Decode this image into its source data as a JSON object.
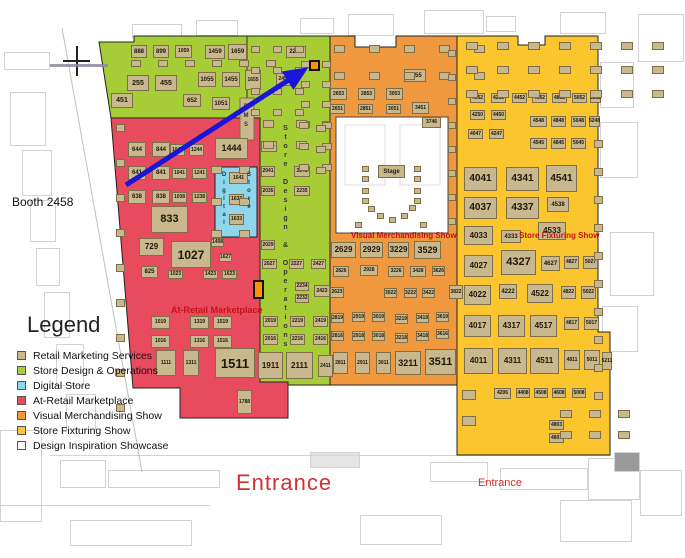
{
  "callout": {
    "label": "Booth 2458"
  },
  "legend": {
    "title": "Legend",
    "items": [
      {
        "label": "Retail Marketing Services",
        "color_key": "tan"
      },
      {
        "label": "Store Design & Operations",
        "color_key": "green"
      },
      {
        "label": "Digital Store",
        "color_key": "blue"
      },
      {
        "label": "At-Retail Marketplace",
        "color_key": "red"
      },
      {
        "label": "Visual Merchandising Show",
        "color_key": "orange"
      },
      {
        "label": "Store Fixturing Show",
        "color_key": "yellow"
      },
      {
        "label": "Design Inspiration Showcase",
        "color_key": "white"
      }
    ]
  },
  "map_labels": {
    "at_retail": "At-Retail Marketplace",
    "visual_merch": "Visual Merchandising Show",
    "store_fixturing": "Store Fixturing Show",
    "stage": "Stage",
    "rms": "RMS",
    "store_design_ops": "Store Design & Operations",
    "digital": "Digital",
    "store": "Store",
    "entrance_main": "Entrance",
    "entrance_side": "Entrance"
  },
  "colors": {
    "tan": "#c9b88e",
    "green": "#a6cc36",
    "blue": "#8ed6ec",
    "red": "#e84a5e",
    "orange": "#f0983e",
    "yellow": "#fbc52e",
    "white": "#ffffff",
    "highlight": "#ff9000",
    "arrow": "#1a16d8",
    "label_red": "#c41414",
    "entrance": "#d23030"
  },
  "booths": [
    [
      "888",
      131,
      45,
      16,
      13,
      6
    ],
    [
      "899",
      153,
      45,
      16,
      13,
      6
    ],
    [
      "1059",
      175,
      45,
      17,
      13,
      5
    ],
    [
      "1459",
      205,
      45,
      20,
      14,
      6
    ],
    [
      "1659",
      228,
      44,
      19,
      16,
      6
    ],
    [
      "2299",
      286,
      46,
      20,
      12,
      6
    ],
    [
      "255",
      127,
      75,
      22,
      16,
      7
    ],
    [
      "455",
      155,
      75,
      22,
      16,
      7
    ],
    [
      "1055",
      198,
      72,
      18,
      15,
      6
    ],
    [
      "1455",
      222,
      72,
      18,
      15,
      6
    ],
    [
      "1655",
      245,
      70,
      16,
      20,
      5
    ],
    [
      "2455",
      276,
      73,
      16,
      13,
      5
    ],
    [
      "451",
      111,
      93,
      22,
      15,
      7
    ],
    [
      "652",
      183,
      94,
      18,
      13,
      6
    ],
    [
      "1051",
      212,
      97,
      18,
      13,
      6
    ],
    [
      "2044",
      261,
      141,
      16,
      11,
      5
    ],
    [
      "2041",
      261,
      166,
      14,
      11,
      5
    ],
    [
      "2241",
      294,
      166,
      16,
      11,
      5
    ],
    [
      "2035",
      261,
      186,
      14,
      10,
      5
    ],
    [
      "2235",
      294,
      186,
      16,
      10,
      5
    ],
    [
      "2029",
      261,
      240,
      14,
      10,
      5
    ],
    [
      "2027",
      262,
      259,
      15,
      10,
      5
    ],
    [
      "2227",
      289,
      259,
      15,
      10,
      5
    ],
    [
      "2427",
      311,
      259,
      15,
      10,
      5
    ],
    [
      "2234",
      295,
      282,
      14,
      9,
      5
    ],
    [
      "2232",
      295,
      294,
      14,
      9,
      5
    ],
    [
      "2423",
      314,
      285,
      16,
      12,
      5
    ],
    [
      "2019",
      263,
      316,
      15,
      11,
      5
    ],
    [
      "2219",
      290,
      316,
      15,
      11,
      5
    ],
    [
      "2419",
      313,
      316,
      15,
      11,
      5
    ],
    [
      "2016",
      263,
      334,
      15,
      11,
      5
    ],
    [
      "2216",
      290,
      334,
      15,
      11,
      5
    ],
    [
      "2416",
      313,
      334,
      15,
      11,
      5
    ],
    [
      "1911",
      258,
      352,
      25,
      27,
      8
    ],
    [
      "2111",
      286,
      352,
      27,
      27,
      8
    ],
    [
      "2411",
      318,
      355,
      15,
      22,
      5
    ],
    [
      "644",
      128,
      142,
      18,
      15,
      6
    ],
    [
      "844",
      152,
      142,
      18,
      15,
      6
    ],
    [
      "1044",
      170,
      144,
      15,
      12,
      5
    ],
    [
      "1244",
      189,
      144,
      15,
      12,
      5
    ],
    [
      "1444",
      215,
      138,
      33,
      21,
      9
    ],
    [
      "641",
      128,
      166,
      18,
      14,
      6
    ],
    [
      "841",
      152,
      166,
      18,
      14,
      6
    ],
    [
      "1041",
      172,
      168,
      15,
      11,
      5
    ],
    [
      "1241",
      192,
      168,
      15,
      11,
      5
    ],
    [
      "638",
      128,
      190,
      18,
      14,
      6
    ],
    [
      "838",
      152,
      190,
      18,
      14,
      6
    ],
    [
      "1038",
      172,
      192,
      15,
      11,
      5
    ],
    [
      "1238",
      192,
      192,
      15,
      11,
      5
    ],
    [
      "833",
      151,
      206,
      37,
      27,
      11
    ],
    [
      "729",
      139,
      238,
      25,
      18,
      8
    ],
    [
      "1027",
      171,
      241,
      40,
      27,
      12
    ],
    [
      "825",
      141,
      266,
      17,
      12,
      6
    ],
    [
      "1408",
      211,
      238,
      13,
      9,
      5
    ],
    [
      "1627",
      219,
      253,
      13,
      9,
      5
    ],
    [
      "1023",
      168,
      270,
      15,
      9,
      5
    ],
    [
      "1423",
      203,
      270,
      15,
      9,
      5
    ],
    [
      "1623",
      222,
      270,
      15,
      9,
      5
    ],
    [
      "1019",
      151,
      316,
      19,
      13,
      5
    ],
    [
      "1319",
      190,
      316,
      19,
      13,
      5
    ],
    [
      "1519",
      213,
      316,
      19,
      13,
      5
    ],
    [
      "1016",
      151,
      335,
      19,
      13,
      5
    ],
    [
      "1316",
      190,
      335,
      19,
      13,
      5
    ],
    [
      "1516",
      213,
      335,
      19,
      13,
      5
    ],
    [
      "1111",
      156,
      350,
      20,
      26,
      5
    ],
    [
      "1311",
      183,
      350,
      16,
      26,
      5
    ],
    [
      "1511",
      215,
      348,
      40,
      30,
      13
    ],
    [
      "1788",
      237,
      390,
      15,
      24,
      5
    ],
    [
      "1641",
      229,
      172,
      19,
      12,
      5
    ],
    [
      "1637",
      229,
      194,
      15,
      11,
      5
    ],
    [
      "1633",
      229,
      214,
      15,
      11,
      5
    ],
    [
      "3455",
      404,
      69,
      22,
      13,
      6
    ],
    [
      "2653",
      330,
      88,
      17,
      12,
      5
    ],
    [
      "2853",
      358,
      88,
      17,
      12,
      5
    ],
    [
      "3053",
      386,
      88,
      17,
      12,
      5
    ],
    [
      "2651",
      330,
      104,
      15,
      10,
      5
    ],
    [
      "2851",
      358,
      104,
      15,
      10,
      5
    ],
    [
      "3051",
      386,
      104,
      15,
      10,
      5
    ],
    [
      "3451",
      412,
      102,
      17,
      12,
      5
    ],
    [
      "3746",
      422,
      117,
      19,
      11,
      5
    ],
    [
      "2629",
      331,
      242,
      25,
      16,
      8
    ],
    [
      "2929",
      360,
      242,
      23,
      16,
      8
    ],
    [
      "3229",
      388,
      242,
      21,
      16,
      8
    ],
    [
      "3529",
      414,
      241,
      27,
      18,
      9
    ],
    [
      "2826",
      333,
      266,
      16,
      11,
      5
    ],
    [
      "2928",
      360,
      265,
      18,
      11,
      5
    ],
    [
      "3226",
      388,
      266,
      16,
      11,
      5
    ],
    [
      "3428",
      410,
      266,
      16,
      11,
      5
    ],
    [
      "3626",
      432,
      266,
      13,
      10,
      5
    ],
    [
      "2623",
      330,
      287,
      14,
      11,
      5
    ],
    [
      "3022",
      384,
      288,
      13,
      10,
      5
    ],
    [
      "3222",
      404,
      288,
      13,
      10,
      5
    ],
    [
      "3422",
      422,
      288,
      13,
      10,
      5
    ],
    [
      "3822",
      449,
      285,
      14,
      14,
      5
    ],
    [
      "2819",
      331,
      313,
      13,
      10,
      5
    ],
    [
      "2919",
      352,
      312,
      13,
      10,
      5
    ],
    [
      "3019",
      372,
      312,
      13,
      10,
      5
    ],
    [
      "3219",
      395,
      314,
      13,
      10,
      5
    ],
    [
      "3419",
      416,
      313,
      13,
      10,
      5
    ],
    [
      "3619",
      436,
      312,
      13,
      10,
      5
    ],
    [
      "2816",
      331,
      331,
      13,
      10,
      5
    ],
    [
      "2918",
      352,
      331,
      13,
      10,
      5
    ],
    [
      "3018",
      372,
      331,
      13,
      10,
      5
    ],
    [
      "3218",
      395,
      333,
      13,
      10,
      5
    ],
    [
      "3418",
      416,
      331,
      13,
      10,
      5
    ],
    [
      "3616",
      436,
      329,
      13,
      10,
      5
    ],
    [
      "2811",
      333,
      352,
      15,
      22,
      5
    ],
    [
      "2911",
      355,
      352,
      15,
      22,
      5
    ],
    [
      "3011",
      376,
      352,
      15,
      22,
      5
    ],
    [
      "3211",
      395,
      351,
      26,
      24,
      9
    ],
    [
      "3511",
      425,
      349,
      31,
      26,
      11
    ],
    [
      "4052",
      470,
      93,
      15,
      10,
      5
    ],
    [
      "4252",
      491,
      93,
      15,
      10,
      5
    ],
    [
      "4452",
      512,
      93,
      15,
      10,
      5
    ],
    [
      "4652",
      532,
      93,
      15,
      10,
      5
    ],
    [
      "4852",
      552,
      93,
      15,
      10,
      5
    ],
    [
      "5052",
      572,
      93,
      15,
      10,
      5
    ],
    [
      "5252",
      590,
      93,
      11,
      10,
      5
    ],
    [
      "4250",
      470,
      110,
      15,
      10,
      5
    ],
    [
      "4450",
      491,
      110,
      15,
      10,
      5
    ],
    [
      "4548",
      530,
      116,
      17,
      11,
      5
    ],
    [
      "4848",
      551,
      116,
      15,
      11,
      5
    ],
    [
      "5048",
      571,
      116,
      15,
      11,
      5
    ],
    [
      "5248",
      589,
      116,
      11,
      11,
      5
    ],
    [
      "4047",
      468,
      129,
      15,
      10,
      5
    ],
    [
      "4247",
      489,
      129,
      15,
      10,
      5
    ],
    [
      "4545",
      530,
      138,
      17,
      11,
      5
    ],
    [
      "4845",
      551,
      138,
      15,
      11,
      5
    ],
    [
      "5045",
      571,
      138,
      15,
      11,
      5
    ],
    [
      "4041",
      464,
      167,
      33,
      24,
      10
    ],
    [
      "4341",
      506,
      167,
      33,
      24,
      10
    ],
    [
      "4541",
      546,
      165,
      31,
      27,
      10
    ],
    [
      "4037",
      464,
      197,
      33,
      22,
      10
    ],
    [
      "4337",
      506,
      197,
      33,
      22,
      10
    ],
    [
      "4538",
      547,
      197,
      22,
      15,
      6
    ],
    [
      "4033",
      464,
      226,
      29,
      19,
      8
    ],
    [
      "4333",
      501,
      230,
      20,
      13,
      6
    ],
    [
      "4533",
      538,
      222,
      28,
      18,
      8
    ],
    [
      "4027",
      464,
      255,
      29,
      22,
      8
    ],
    [
      "4327",
      501,
      250,
      35,
      25,
      11
    ],
    [
      "4627",
      541,
      256,
      19,
      15,
      6
    ],
    [
      "4827",
      564,
      256,
      15,
      13,
      5
    ],
    [
      "5027",
      583,
      256,
      15,
      13,
      5
    ],
    [
      "4022",
      464,
      285,
      27,
      20,
      8
    ],
    [
      "4222",
      499,
      284,
      18,
      15,
      6
    ],
    [
      "4522",
      527,
      284,
      26,
      19,
      8
    ],
    [
      "4822",
      561,
      286,
      15,
      13,
      5
    ],
    [
      "5022",
      581,
      286,
      15,
      13,
      5
    ],
    [
      "4017",
      464,
      315,
      27,
      22,
      8
    ],
    [
      "4317",
      498,
      315,
      27,
      22,
      8
    ],
    [
      "4517",
      530,
      315,
      27,
      22,
      8
    ],
    [
      "4817",
      564,
      317,
      15,
      13,
      5
    ],
    [
      "5017",
      584,
      317,
      15,
      13,
      5
    ],
    [
      "4011",
      464,
      348,
      29,
      26,
      8
    ],
    [
      "4311",
      498,
      348,
      29,
      26,
      8
    ],
    [
      "4511",
      530,
      348,
      29,
      26,
      8
    ],
    [
      "4811",
      564,
      350,
      16,
      20,
      5
    ],
    [
      "5011",
      584,
      350,
      16,
      20,
      5
    ],
    [
      "5211",
      602,
      352,
      10,
      18,
      5
    ],
    [
      "4206",
      494,
      388,
      17,
      11,
      5
    ],
    [
      "4408",
      516,
      388,
      14,
      10,
      5
    ],
    [
      "4508",
      534,
      388,
      14,
      10,
      5
    ],
    [
      "4608",
      552,
      388,
      14,
      10,
      5
    ],
    [
      "5008",
      572,
      388,
      14,
      10,
      5
    ],
    [
      "4803",
      549,
      420,
      15,
      10,
      5
    ],
    [
      "4801",
      549,
      433,
      15,
      10,
      5
    ]
  ],
  "booth_grids": [
    [
      131,
      60,
      6,
      1,
      10,
      7,
      17,
      0
    ],
    [
      251,
      46,
      3,
      4,
      9,
      7,
      13,
      14
    ],
    [
      301,
      61,
      2,
      4,
      9,
      7,
      12,
      13
    ],
    [
      263,
      120,
      2,
      2,
      11,
      8,
      22,
      13
    ],
    [
      299,
      122,
      2,
      3,
      10,
      7,
      13,
      14
    ],
    [
      316,
      125,
      1,
      3,
      10,
      7,
      0,
      14
    ],
    [
      116,
      124,
      1,
      9,
      9,
      8,
      0,
      27
    ],
    [
      211,
      166,
      2,
      3,
      11,
      8,
      17,
      24
    ],
    [
      334,
      45,
      5,
      2,
      11,
      8,
      24,
      19
    ],
    [
      448,
      50,
      1,
      8,
      8,
      7,
      0,
      17
    ],
    [
      466,
      42,
      7,
      3,
      12,
      8,
      19,
      16
    ],
    [
      594,
      140,
      1,
      10,
      9,
      8,
      0,
      20
    ],
    [
      462,
      390,
      1,
      2,
      14,
      10,
      0,
      16
    ],
    [
      560,
      410,
      3,
      2,
      12,
      8,
      17,
      13
    ]
  ],
  "stage_tables": [
    [
      362,
      166
    ],
    [
      362,
      176
    ],
    [
      362,
      188
    ],
    [
      362,
      198
    ],
    [
      414,
      166
    ],
    [
      414,
      176
    ],
    [
      414,
      188
    ],
    [
      414,
      198
    ],
    [
      368,
      206
    ],
    [
      377,
      213
    ],
    [
      389,
      217
    ],
    [
      401,
      213
    ],
    [
      409,
      205
    ],
    [
      355,
      222
    ],
    [
      420,
      222
    ]
  ],
  "highlight_booths": [
    [
      309,
      60,
      11,
      11
    ],
    [
      253,
      280,
      11,
      19
    ]
  ]
}
